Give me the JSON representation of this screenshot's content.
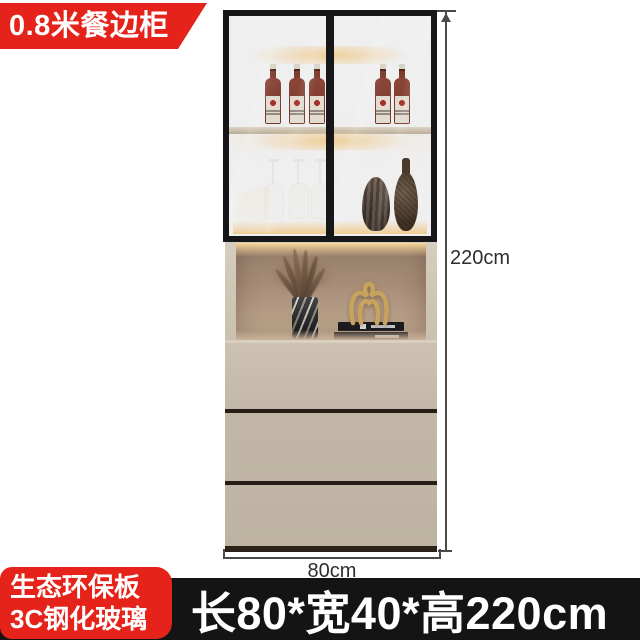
{
  "ribbon": {
    "label": "0.8米餐边柜"
  },
  "material_badge": {
    "line1": "生态环保板",
    "line2": "3C钢化玻璃"
  },
  "size_bar": {
    "text": "长80*宽40*高220cm"
  },
  "dimensions": {
    "height_label": "220cm",
    "width_label": "80cm"
  },
  "colors": {
    "accent_red": "#e5231b",
    "bar_black": "#141414",
    "cabinet_frame": "#17171a",
    "drawer_beige": "#c2b7a6",
    "niche_taupe": "#a68c76",
    "led_glow": "#ffd9a4",
    "dimension_line": "#4a4a4a"
  },
  "decor_items": [
    "wine-bottles",
    "wine-glasses",
    "ribbed-vase",
    "teardrop-vase",
    "dried-plant",
    "marble-vase",
    "books",
    "gold-sculpture"
  ]
}
